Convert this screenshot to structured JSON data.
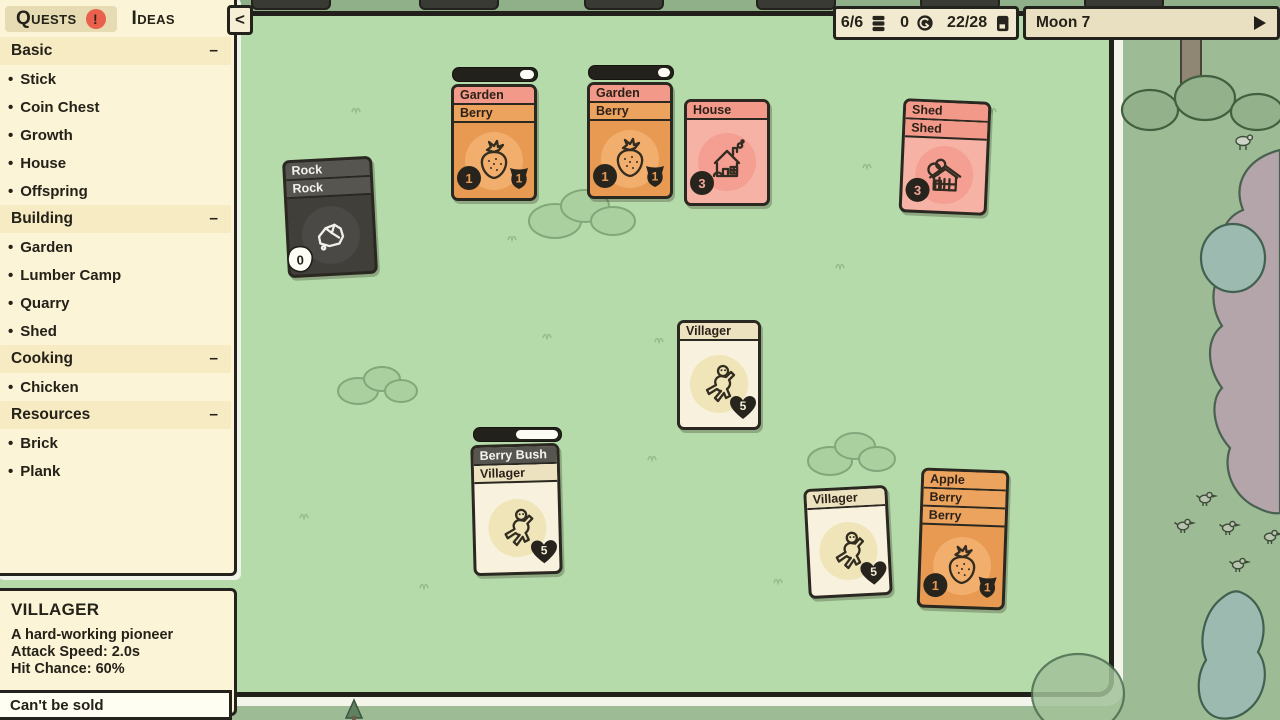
{
  "hud": {
    "card_count": "6/6",
    "coin_count": "0",
    "deck_count": "22/28",
    "moon_label": "Moon 7"
  },
  "sidebar": {
    "tabs": [
      {
        "id": "quests",
        "label": "Quests",
        "active": true,
        "alert": "!"
      },
      {
        "id": "ideas",
        "label": "Ideas",
        "active": false
      }
    ],
    "collapse_button": "<",
    "bullet": "•",
    "sections": [
      {
        "title": "Basic",
        "collapse": "–",
        "items": [
          "Stick",
          "Coin Chest",
          "Growth",
          "House",
          "Offspring"
        ]
      },
      {
        "title": "Building",
        "collapse": "–",
        "items": [
          "Garden",
          "Lumber Camp",
          "Quarry",
          "Shed"
        ]
      },
      {
        "title": "Cooking",
        "collapse": "–",
        "items": [
          "Chicken"
        ]
      },
      {
        "title": "Resources",
        "collapse": "–",
        "items": [
          "Brick",
          "Plank"
        ]
      }
    ]
  },
  "info_panel": {
    "title": "VILLAGER",
    "description": "A hard-working pioneer",
    "stats": [
      "Attack Speed: 2.0s",
      "Hit Chance: 60%"
    ],
    "footer": "Can't be sold"
  },
  "board": {
    "cards": [
      {
        "id": "rock-stack",
        "x": 285,
        "y": 158,
        "w": 90,
        "h": 118,
        "rot": -3,
        "body": "dark",
        "headers": [
          {
            "label": "Rock",
            "style": "dark"
          },
          {
            "label": "Rock",
            "style": "dark"
          }
        ],
        "art": "rock",
        "badges": [
          {
            "shape": "blob",
            "value": "0",
            "corner": "bl"
          }
        ]
      },
      {
        "id": "garden-berry-1",
        "x": 451,
        "y": 84,
        "w": 86,
        "h": 117,
        "rot": 0,
        "body": "orange",
        "headers": [
          {
            "label": "Garden",
            "style": "salmon"
          },
          {
            "label": "Berry",
            "style": "orange"
          }
        ],
        "art": "strawberry",
        "timer": {
          "progress": 0.18
        },
        "badges": [
          {
            "shape": "coin",
            "value": "1",
            "corner": "bl"
          },
          {
            "shape": "shield",
            "value": "1",
            "corner": "br"
          }
        ]
      },
      {
        "id": "garden-berry-2",
        "x": 587,
        "y": 82,
        "w": 86,
        "h": 117,
        "rot": 0,
        "body": "orange",
        "headers": [
          {
            "label": "Garden",
            "style": "salmon"
          },
          {
            "label": "Berry",
            "style": "orange"
          }
        ],
        "art": "strawberry",
        "timer": {
          "progress": 0.15
        },
        "badges": [
          {
            "shape": "coin",
            "value": "1",
            "corner": "bl"
          },
          {
            "shape": "shield",
            "value": "1",
            "corner": "br"
          }
        ]
      },
      {
        "id": "house",
        "x": 684,
        "y": 99,
        "w": 86,
        "h": 107,
        "rot": 0,
        "body": "pink",
        "headers": [
          {
            "label": "House",
            "style": "salmon"
          }
        ],
        "art": "house",
        "badges": [
          {
            "shape": "coin",
            "value": "3",
            "corner": "bl"
          }
        ]
      },
      {
        "id": "shed-stack",
        "x": 901,
        "y": 100,
        "w": 88,
        "h": 114,
        "rot": 2.5,
        "body": "pink",
        "headers": [
          {
            "label": "Shed",
            "style": "salmon"
          },
          {
            "label": "Shed",
            "style": "salmon"
          }
        ],
        "art": "shed",
        "badges": [
          {
            "shape": "coin",
            "value": "3",
            "corner": "bl"
          }
        ]
      },
      {
        "id": "villager-1",
        "x": 677,
        "y": 320,
        "w": 84,
        "h": 110,
        "rot": 0,
        "body": "cream",
        "headers": [
          {
            "label": "Villager",
            "style": "cream"
          }
        ],
        "art": "villager",
        "badges": [
          {
            "shape": "heart",
            "value": "5",
            "corner": "br"
          }
        ]
      },
      {
        "id": "berrybush-villager",
        "x": 472,
        "y": 444,
        "w": 89,
        "h": 131,
        "rot": -1.5,
        "body": "cream",
        "headers": [
          {
            "label": "Berry Bush",
            "style": "dark"
          },
          {
            "label": "Villager",
            "style": "cream"
          }
        ],
        "art": "villager",
        "timer": {
          "progress": 0.52
        },
        "badges": [
          {
            "shape": "heart",
            "value": "5",
            "corner": "br"
          }
        ]
      },
      {
        "id": "villager-2",
        "x": 806,
        "y": 487,
        "w": 84,
        "h": 110,
        "rot": -3,
        "body": "cream",
        "headers": [
          {
            "label": "Villager",
            "style": "cream"
          }
        ],
        "art": "villager",
        "badges": [
          {
            "shape": "heart",
            "value": "5",
            "corner": "br"
          }
        ]
      },
      {
        "id": "apple-berry-berry",
        "x": 919,
        "y": 469,
        "w": 88,
        "h": 140,
        "rot": 2,
        "body": "orange",
        "headers": [
          {
            "label": "Apple",
            "style": "orange"
          },
          {
            "label": "Berry",
            "style": "orange"
          },
          {
            "label": "Berry",
            "style": "orange"
          }
        ],
        "art": "strawberry",
        "badges": [
          {
            "shape": "coin",
            "value": "1",
            "corner": "bl"
          },
          {
            "shape": "shield",
            "value": "1",
            "corner": "br"
          }
        ]
      }
    ]
  },
  "colors": {
    "outside": "#9dbc95",
    "board": "#b6dbaa",
    "board_border": "#21201a",
    "panel_cream": "#fcf4d7",
    "alert_red": "#e9614d",
    "salmon": "#f2998a",
    "orange": "#e89a52",
    "pink": "#f6b2a4",
    "cream_card": "#f7f1dd",
    "dark_card": "#413f3a",
    "badge_dark": "#26241d"
  }
}
